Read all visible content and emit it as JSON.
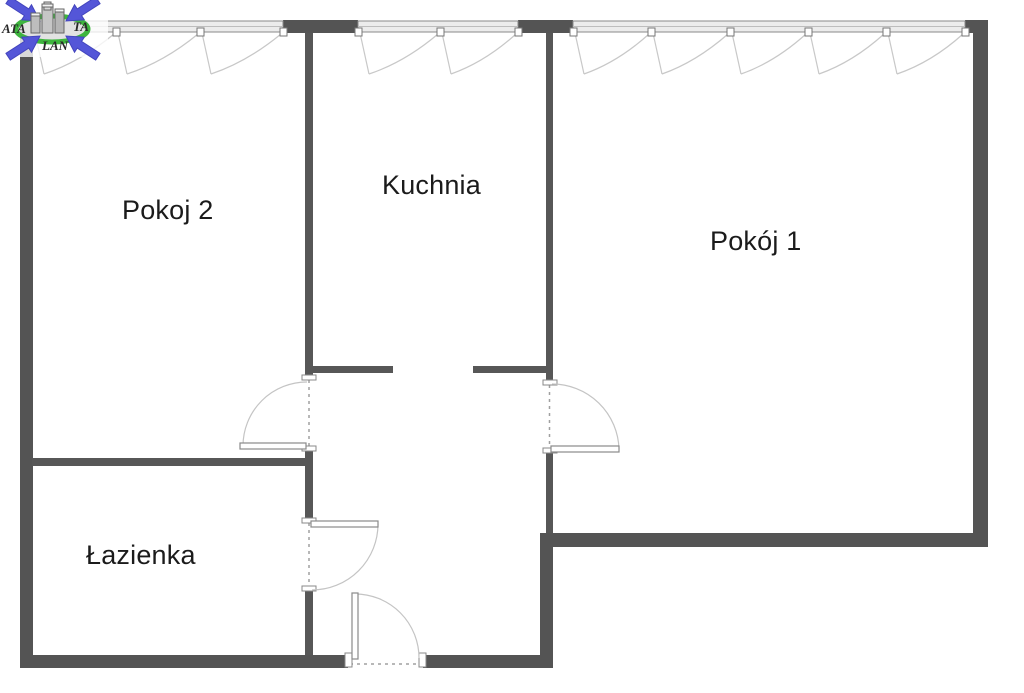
{
  "plan": {
    "type": "apartment-floor-plan",
    "rooms": [
      {
        "id": "pokoj-2",
        "label": "Pokoj 2"
      },
      {
        "id": "kuchnia",
        "label": "Kuchnia"
      },
      {
        "id": "pokoj-1",
        "label": "Pokój 1"
      },
      {
        "id": "lazienka",
        "label": "Łazienka"
      }
    ],
    "watermark": {
      "text_left": "ATA",
      "text_right": "TA",
      "text_bottom": "LAN"
    },
    "colors": {
      "wall": "#545454",
      "interior_wall": "#575757",
      "window_fill": "#ececec",
      "window_line": "#8a8a8a",
      "door_line": "#c4c4c4",
      "logo_blue": "#5456d8",
      "logo_green": "#3eb53e",
      "text": "#1b1b1b",
      "background": "#ffffff"
    }
  }
}
